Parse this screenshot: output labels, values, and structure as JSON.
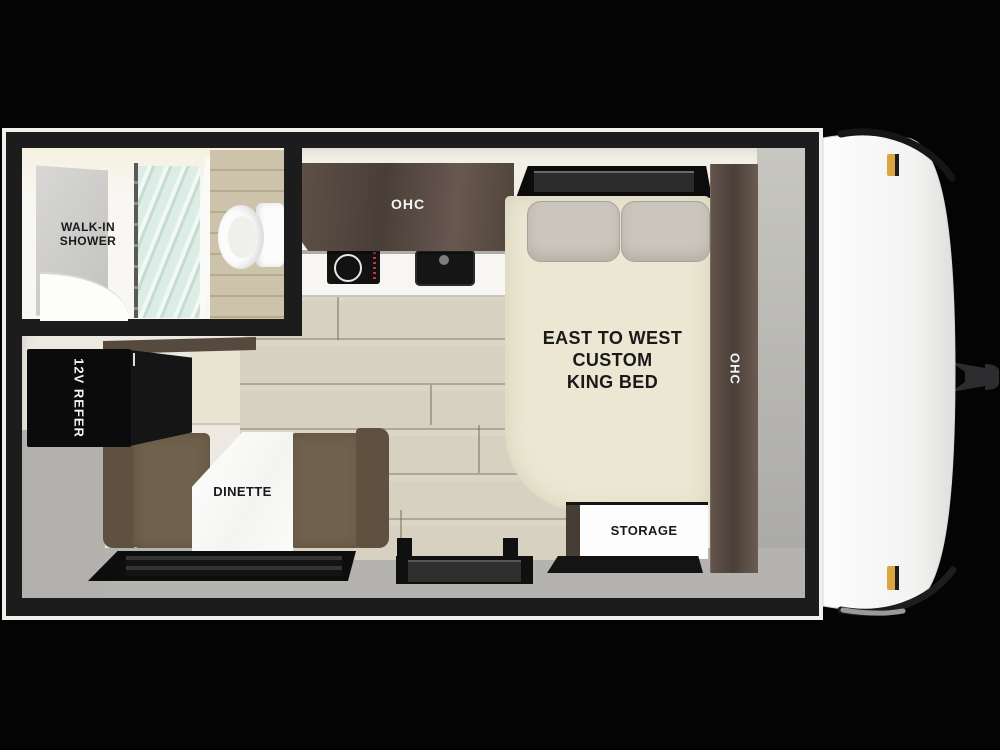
{
  "title": "Travel trailer floor plan",
  "labels": {
    "walk_in_1": "WALK-IN",
    "walk_in_2": "SHOWER",
    "kitchen_ohc": "OHC",
    "bedside_ohc": "OHC",
    "bed_1": "EAST TO WEST",
    "bed_2": "CUSTOM",
    "bed_3": "KING BED",
    "refer": "12V REFER",
    "dinette": "DINETTE",
    "storage": "STORAGE"
  },
  "colors": {
    "wall_black": "#1c1c1c",
    "outer_border_white": "#f2f0ea",
    "interior_floor": "#ebe9e2",
    "wood_floor": "#d6d1c0",
    "walnut_cabinet": "#554940",
    "mattress_cream": "#ebe7d3",
    "pillow_gray": "#cac6bd",
    "bench_brown": "#70614d",
    "perimeter_gray": "#b4b3af",
    "bath_plank_tan": "#cdc3ab",
    "shower_glass_green": "#d9ece4",
    "table_white": "#fbfbfa",
    "refrigerator_black": "#0b0b0b",
    "window_black": "#0d0d0d",
    "front_cap_white": "#f6f6f5",
    "trim_black": "#161616",
    "marker_light_amber": "#dba53f",
    "hitch_gray": "#2d2d2f"
  }
}
